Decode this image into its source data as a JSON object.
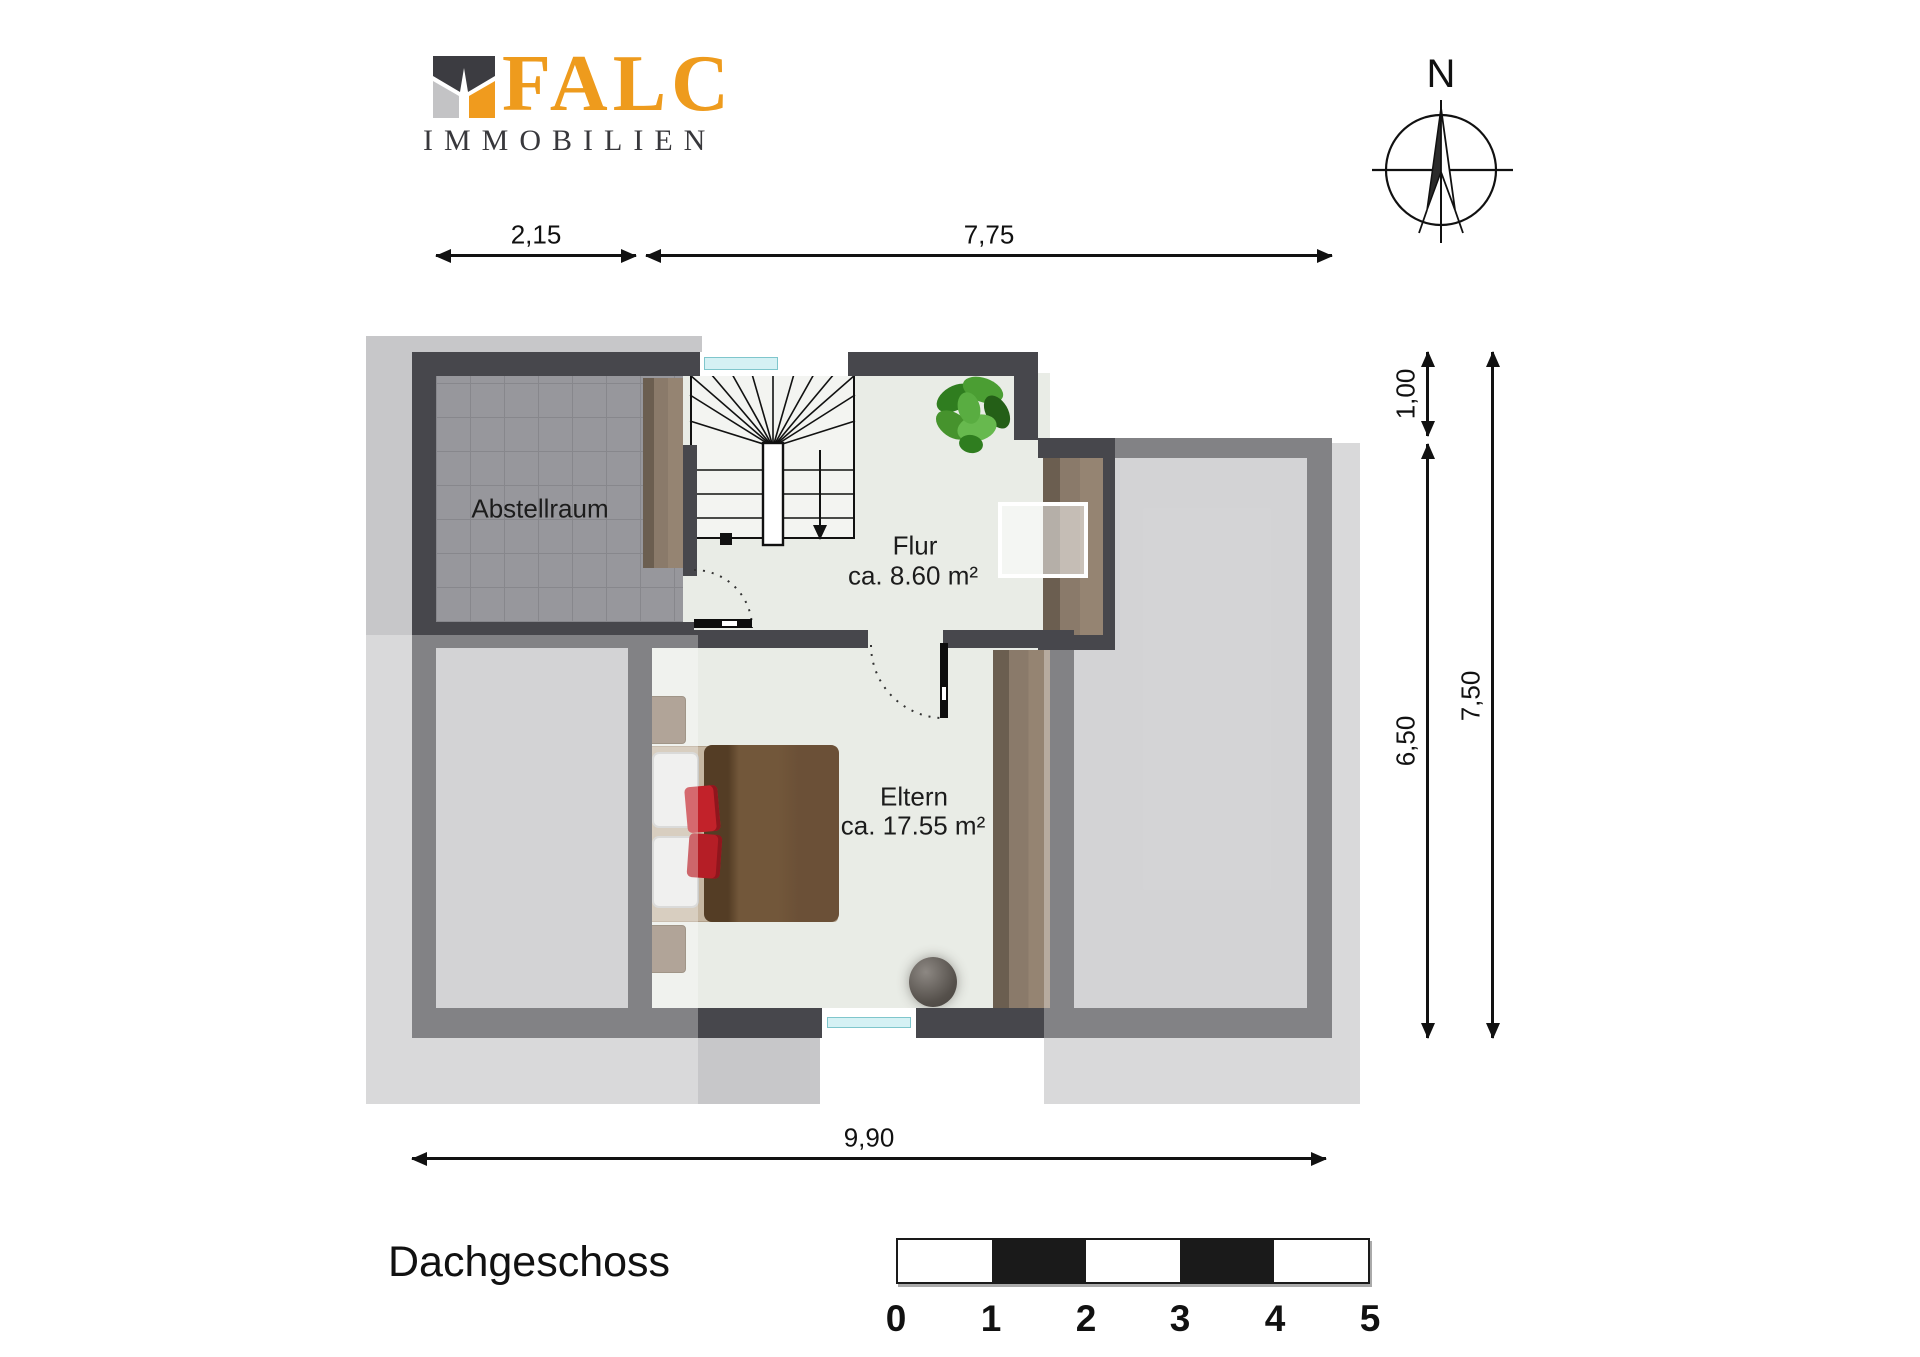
{
  "logo": {
    "brand": "FALC",
    "sub": "IMMOBILIEN"
  },
  "compass": {
    "label": "N"
  },
  "dimensions": {
    "top": [
      {
        "label": "2,15"
      },
      {
        "label": "7,75"
      }
    ],
    "bottom": {
      "label": "9,90"
    },
    "right": [
      {
        "label": "1,00"
      },
      {
        "label": "6,50"
      },
      {
        "label": "7,50"
      }
    ]
  },
  "rooms": {
    "abstellraum": {
      "name": "Abstellraum"
    },
    "flur": {
      "name": "Flur",
      "area": "ca. 8.60 m²"
    },
    "eltern": {
      "name": "Eltern",
      "area": "ca. 17.55 m²"
    }
  },
  "floor_title": "Dachgeschoss",
  "scale_bar": {
    "labels": [
      "0",
      "1",
      "2",
      "3",
      "4",
      "5"
    ]
  },
  "colors": {
    "brand_orange": "#ee9b1d",
    "brand_dark": "#38383c",
    "wall": "#47474c",
    "floor_light": "#e9ece6",
    "floor_gray": "#bfbfc2",
    "tile_gray": "#97979c",
    "roof_shadow": "#c7c7c9",
    "wood": "#8a7a6a",
    "bed_blanket": "#6b5037",
    "pillow_red": "#c2222a",
    "window_glass": "#d5f1f4",
    "plant_green": "#4b9e33"
  }
}
